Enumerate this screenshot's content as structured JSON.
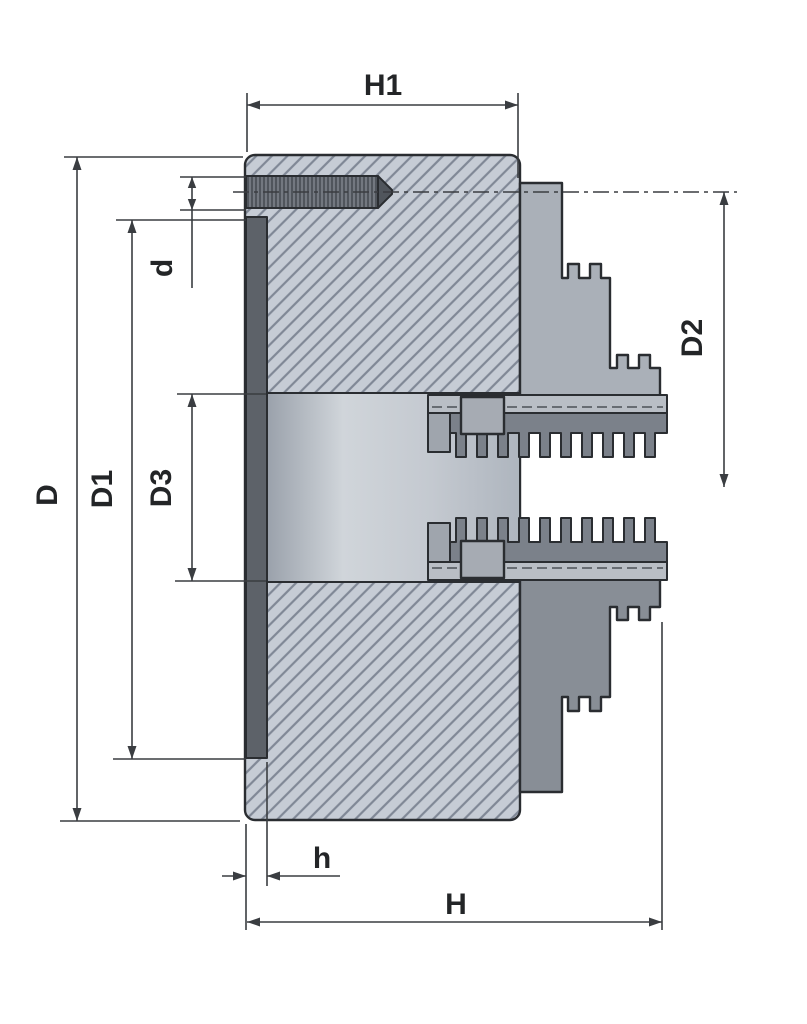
{
  "dims": {
    "h1": "H1",
    "d": "d",
    "d2": "D2",
    "D": "D",
    "d1": "D1",
    "d3": "D3",
    "h": "h",
    "H": "H"
  },
  "colors": {
    "bg": "#ffffff",
    "line": "#2a2d31",
    "dim": "#3a3d41",
    "text": "#232527",
    "hatch_bg": "#c6ccd5",
    "hatch_line": "#808896",
    "bore_left": "#9aa1ab",
    "bore_mid": "#d0d5da",
    "bore_right": "#aeb5be",
    "strip": "#5d6269",
    "thread_bg": "#50555c",
    "thread_line": "#8a9099",
    "jaw_top": "#aab0b8",
    "jaw_bottom": "#888e96",
    "plate": "#b9bec5",
    "bar": "#9fa5ad",
    "rack": "#7b818a",
    "block": "#a6abb3"
  }
}
